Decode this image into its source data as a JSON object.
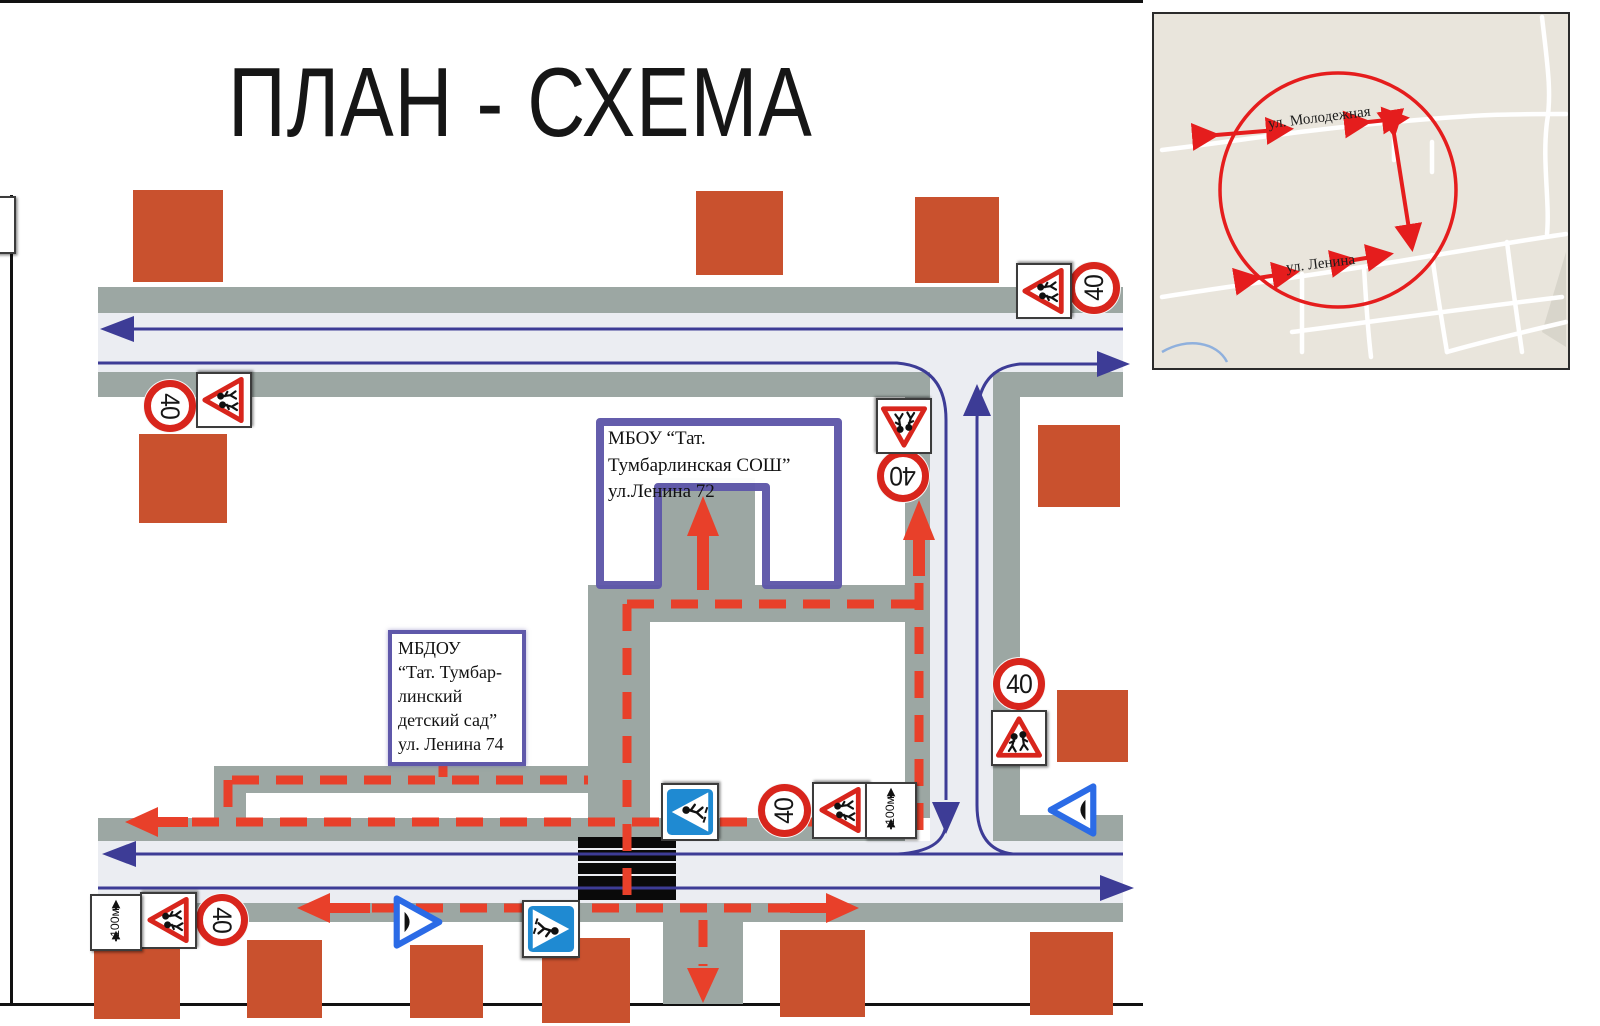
{
  "title": "ПЛАН - СХЕМА",
  "labels": {
    "school": "МБОУ “Тат. Тумбарлинская СОШ” ул.Ленина 72",
    "kindergarten": "МБДОУ\n“Тат. Тумбар-\nлинский\nдетский сад”\nул. Ленина 74"
  },
  "signs": {
    "speed_limit": "40",
    "distance_plate": "100м"
  },
  "inset_map": {
    "street_top": "ул. Молодежная",
    "street_bottom": "ул. Ленина"
  },
  "colors": {
    "route_red": "#e8402a",
    "traffic_blue": "#3d3c96",
    "sidewalk_gray": "#9ca7a3",
    "roadway_light": "#ebedf2",
    "building_orange": "#c9512e",
    "outline_purple": "#5f58aa",
    "sign_red": "#d8251c",
    "sign_blue": "#1f8ad2",
    "bump_sign_blue": "#2b6be6"
  }
}
